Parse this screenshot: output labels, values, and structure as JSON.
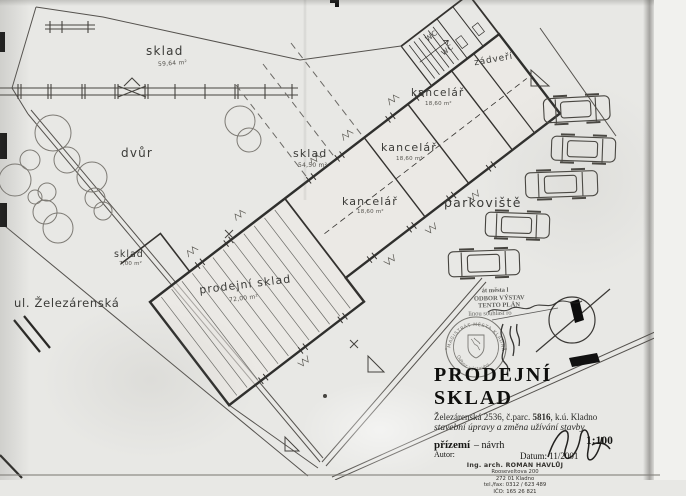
{
  "title_block": {
    "title": "PRODEJNÍ SKLAD",
    "address_pre": "Železárenská 2536, č.parc. ",
    "address_parcel": "5816",
    "address_post": ", k.ú. Kladno",
    "subtitle": "stavební úpravy a změna užívání stavby",
    "phase": "přízemí",
    "phase_suffix": " – návrh",
    "scale": "1:100",
    "author_label": "Autor:",
    "date_label": "Datum: 11/2001",
    "author": {
      "name": "Ing. arch. ROMAN HAVLŮJ",
      "street": "Rooseveltova 200",
      "city": "272 01 Kladno",
      "phone": "tel./fax: 0312 / 623 489",
      "reg": "IČO: 165 26 821"
    }
  },
  "rooms": {
    "sklad_yard": {
      "name": "sklad",
      "area": "59,64 m²"
    },
    "dvur": {
      "name": "dvůr"
    },
    "sklad_mid": {
      "name": "sklad",
      "area": "54,50 m²"
    },
    "sklad_small": {
      "name": "sklad",
      "area": "7,00 m²"
    },
    "prodejni": {
      "name": "prodejní sklad",
      "area": "72,00 m²"
    },
    "kancelar_1": {
      "name": "kancelář",
      "area": "18,60 m²"
    },
    "kancelar_2": {
      "name": "kancelář",
      "area": "18,60 m²"
    },
    "kancelar_3": {
      "name": "kancelář",
      "area": "18,60 m²"
    },
    "zadveri": {
      "name": "zádveří"
    },
    "wc_1": {
      "name": "WC"
    },
    "wc_2": {
      "name": "WC"
    },
    "parkoviste": {
      "name": "parkoviště"
    }
  },
  "site": {
    "street": "ul. Železárenská"
  },
  "stamp": {
    "line1": "át města l",
    "line2": "ODBOR VÝSTAV",
    "line3": "TENTO PLÁN",
    "line4": "linou souhlasí ro",
    "seal_top": "MAGISTRÁT MĚSTA KLADNA",
    "seal_bottom": "Odbor výstavby"
  },
  "colors": {
    "ink": "#3b3b38",
    "wall": "#2f2f2d",
    "paper": "#e8e8e5",
    "faint": "#7d7a74"
  }
}
